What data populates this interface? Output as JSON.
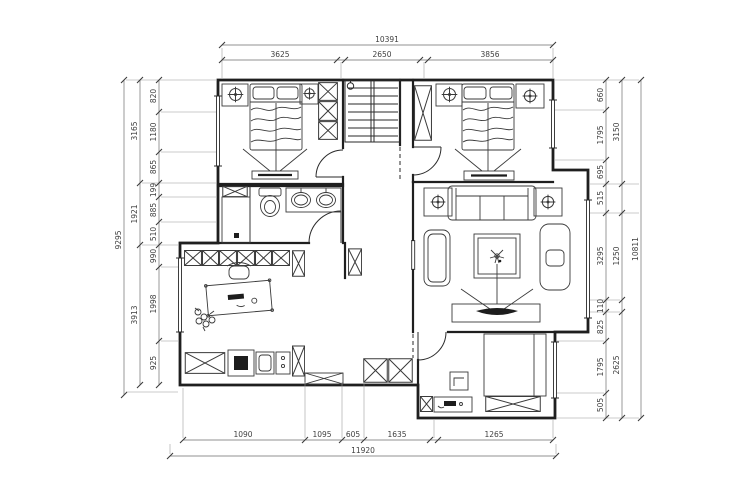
{
  "drawing": {
    "kind": "residential-floor-plan",
    "colors": {
      "line": "#1f1f1f",
      "dim_text": "#3f3f3f",
      "background": "#ffffff"
    },
    "symbols": [
      "stairs",
      "crossed-box-cabinet",
      "ceiling-lamp",
      "bed",
      "toilet",
      "double-vanity-sinks",
      "sofa",
      "coffee-table-plant",
      "tv-arc",
      "desk-chair",
      "door-swing-arc",
      "window-double-line"
    ]
  },
  "dims": {
    "top": {
      "total": "10391",
      "segments": [
        "3625",
        "2650",
        "3856"
      ]
    },
    "bottom": {
      "segments": [
        "1090",
        "1095",
        "605",
        "1635",
        "1265"
      ],
      "total": "11920"
    },
    "left": {
      "total": "9295",
      "groups": [
        "3165",
        "1921",
        "3913"
      ],
      "inner": [
        "820",
        "1180",
        "865",
        "199",
        "885",
        "510",
        "990",
        "1998",
        "925"
      ]
    },
    "right": {
      "inner": [
        "660",
        "1795",
        "695",
        "515",
        "3295",
        "110",
        "825",
        "1795",
        "505"
      ],
      "groups": [
        "3150",
        "1250",
        "2625"
      ],
      "total": "10811"
    }
  }
}
